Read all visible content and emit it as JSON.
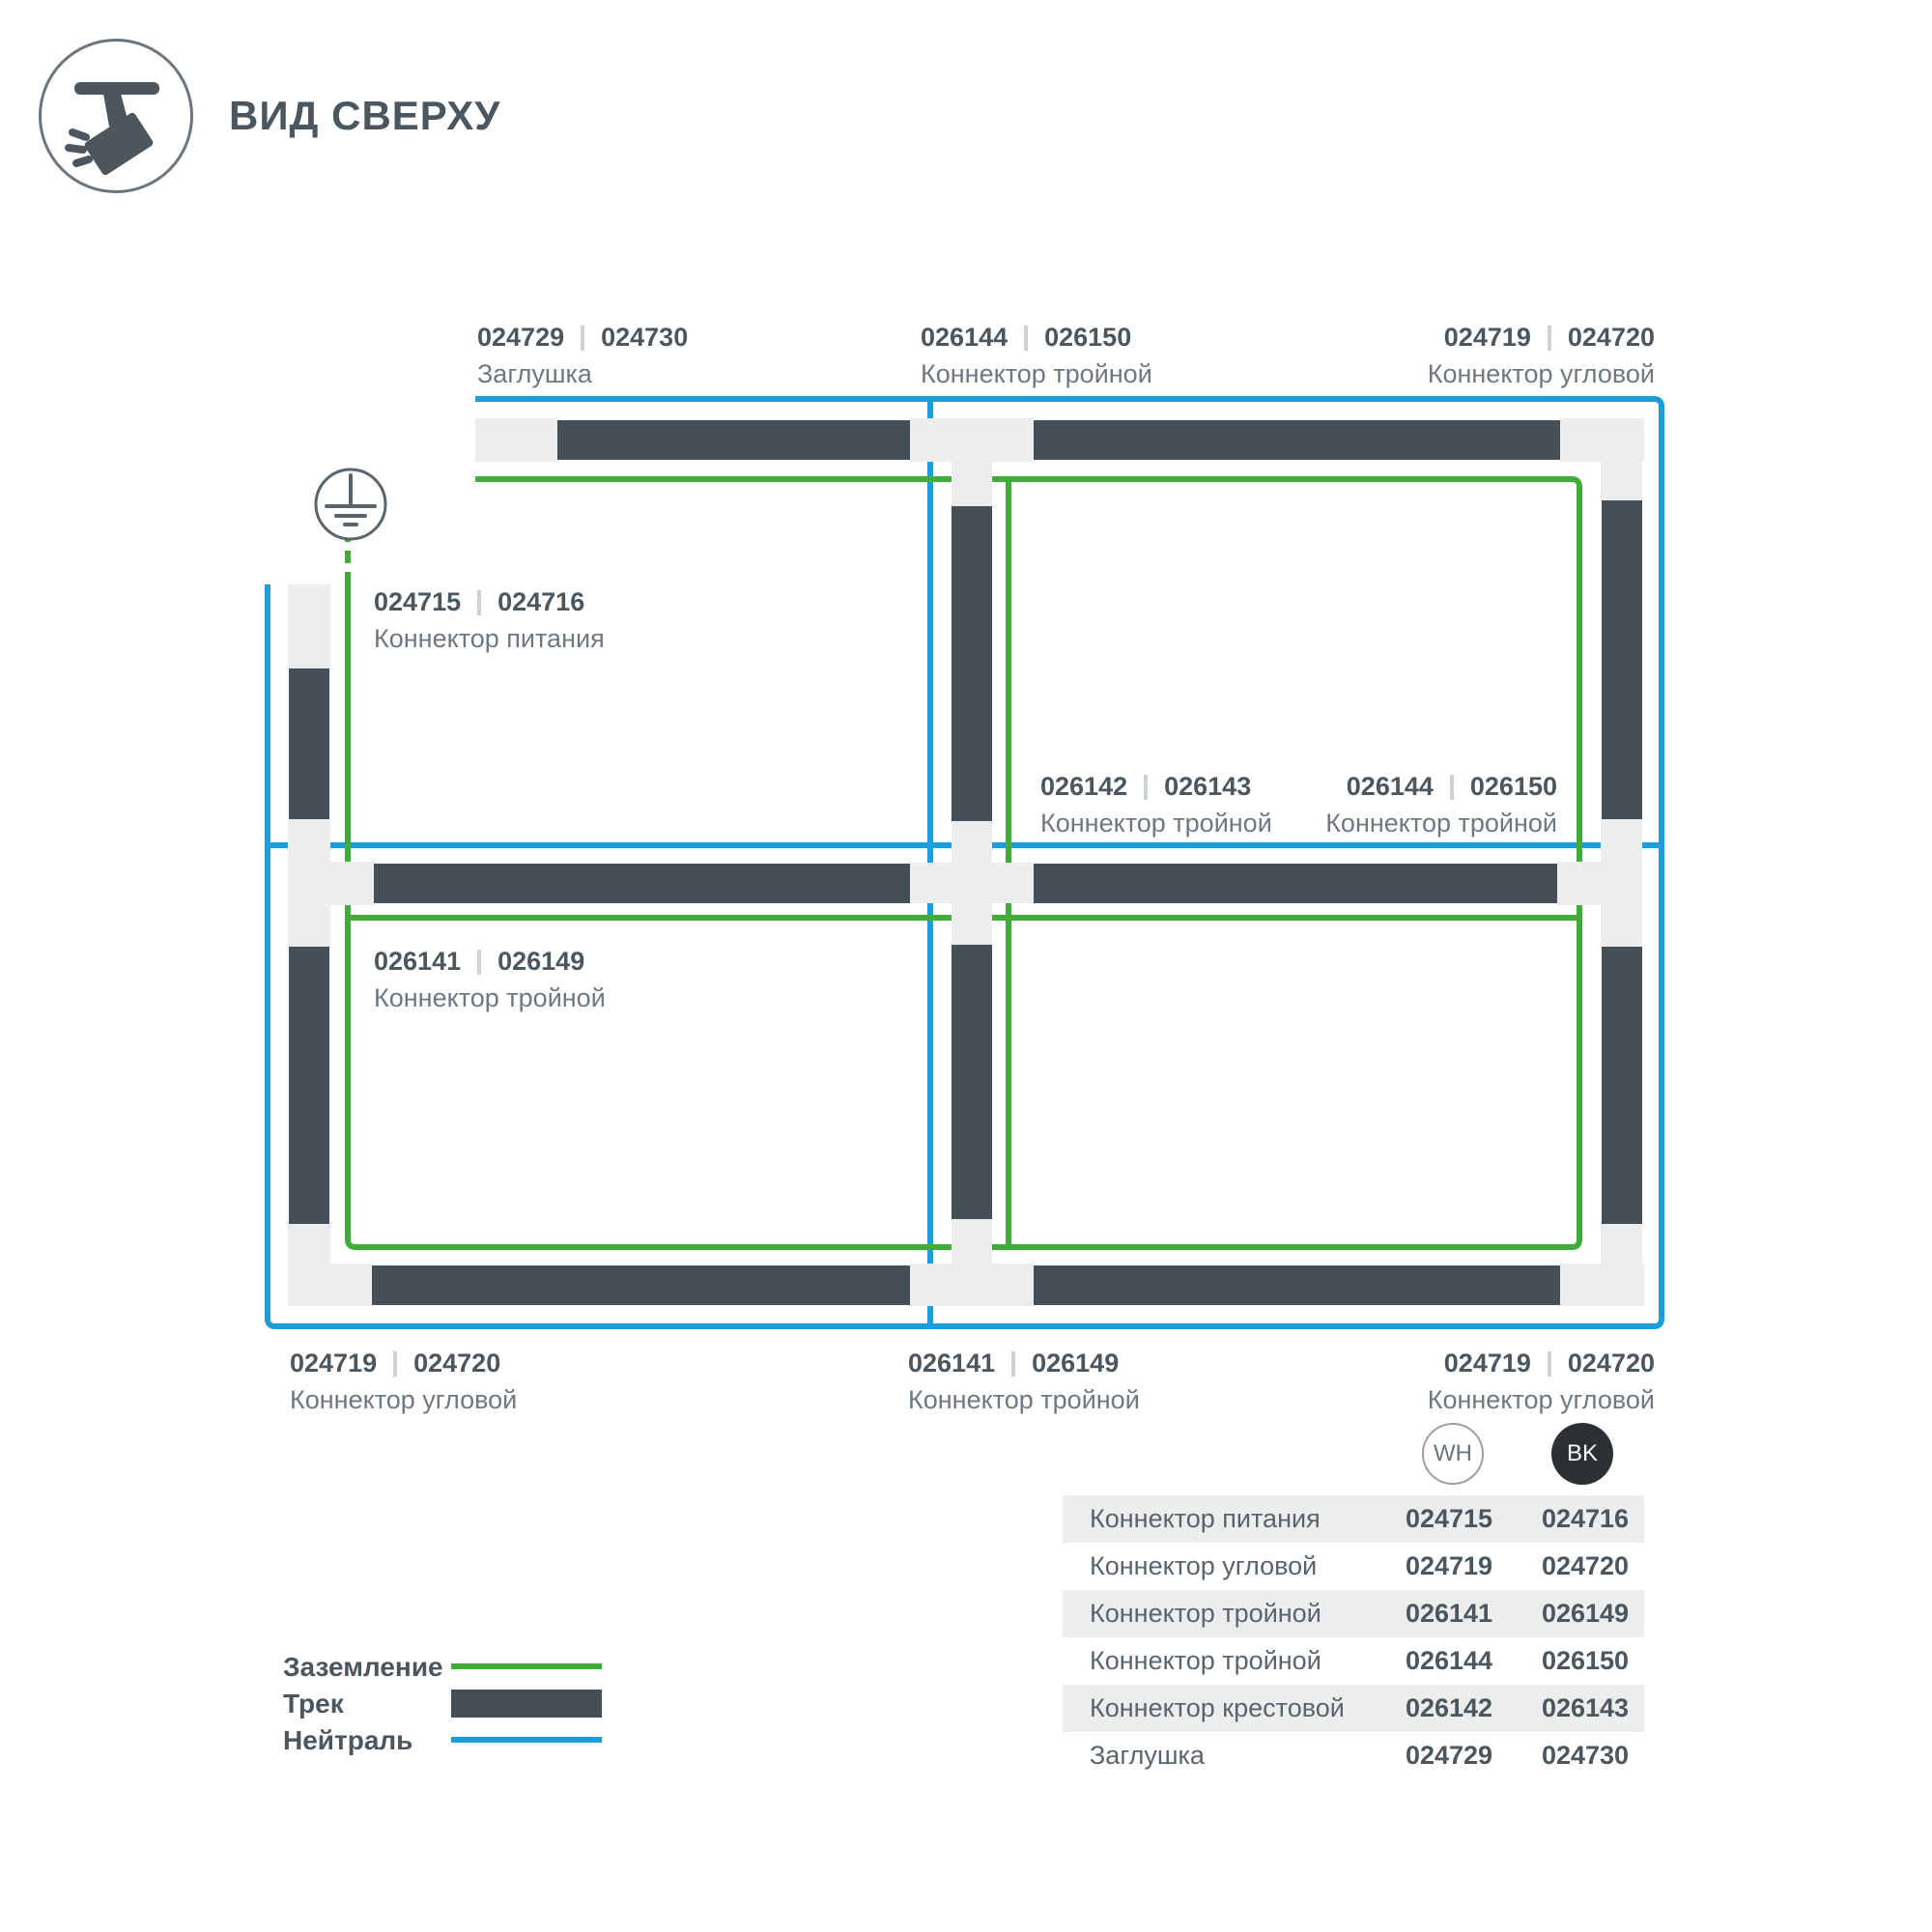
{
  "header": {
    "title": "ВИД СВЕРХУ"
  },
  "diagram": {
    "colors": {
      "ground_wire": "#41ab3c",
      "neutral_wire": "#1d9dd9",
      "track": "#454f58",
      "connector_housing": "#ecedee"
    },
    "labels": {
      "top_left": {
        "num1": "024729",
        "num2": "024730",
        "name": "Заглушка"
      },
      "top_middle": {
        "num1": "026144",
        "num2": "026150",
        "name": "Коннектор тройной"
      },
      "top_right": {
        "num1": "024719",
        "num2": "024720",
        "name": "Коннектор угловой"
      },
      "power": {
        "num1": "024715",
        "num2": "024716",
        "name": "Коннектор питания"
      },
      "center": {
        "num1": "026142",
        "num2": "026143",
        "name": "Коннектор тройной"
      },
      "mid_right": {
        "num1": "026144",
        "num2": "026150",
        "name": "Коннектор тройной"
      },
      "cell_bottom_left": {
        "num1": "026141",
        "num2": "026149",
        "name": "Коннектор тройной"
      },
      "bottom_left": {
        "num1": "024719",
        "num2": "024720",
        "name": "Коннектор угловой"
      },
      "bottom_middle": {
        "num1": "026141",
        "num2": "026149",
        "name": "Коннектор тройной"
      },
      "bottom_right": {
        "num1": "024719",
        "num2": "024720",
        "name": "Коннектор угловой"
      }
    }
  },
  "legend": {
    "items": [
      {
        "label": "Заземление",
        "type": "ground"
      },
      {
        "label": "Трек",
        "type": "track"
      },
      {
        "label": "Нейтраль",
        "type": "neutral"
      }
    ]
  },
  "variants": {
    "wh": "WH",
    "bk": "BK"
  },
  "table": {
    "rows": [
      {
        "name": "Коннектор питания",
        "wh": "024715",
        "bk": "024716"
      },
      {
        "name": "Коннектор угловой",
        "wh": "024719",
        "bk": "024720"
      },
      {
        "name": "Коннектор тройной",
        "wh": "026141",
        "bk": "026149"
      },
      {
        "name": "Коннектор тройной",
        "wh": "026144",
        "bk": "026150"
      },
      {
        "name": "Коннектор крестовой",
        "wh": "026142",
        "bk": "026143"
      },
      {
        "name": "Заглушка",
        "wh": "024729",
        "bk": "024730"
      }
    ]
  }
}
